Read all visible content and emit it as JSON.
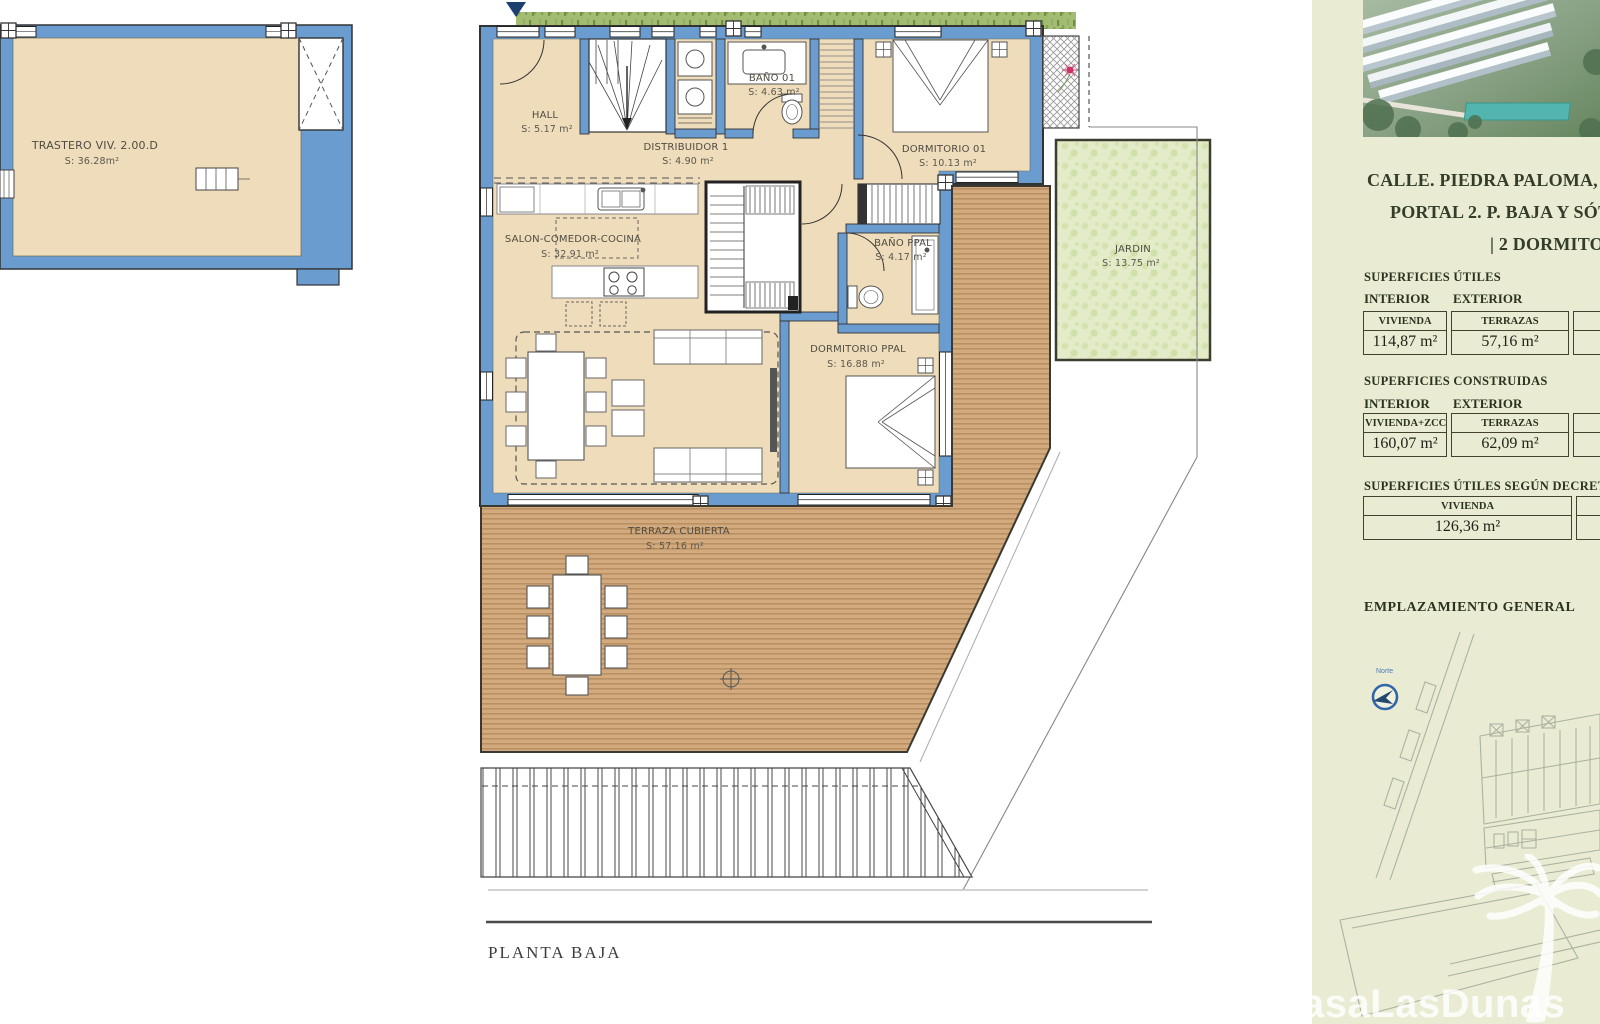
{
  "plan": {
    "title": "PLANTA BAJA",
    "rooms": [
      {
        "name": "TRASTERO VIV. 2.00.D",
        "area": "S: 36.28m²"
      },
      {
        "name": "HALL",
        "area": "S: 5.17 m²"
      },
      {
        "name": "BAÑO 01",
        "area": "S: 4.63 m²"
      },
      {
        "name": "DORMITORIO 01",
        "area": "S: 10.13 m²"
      },
      {
        "name": "DISTRIBUIDOR 1",
        "area": "S: 4.90 m²"
      },
      {
        "name": "SALON-COMEDOR-COCINA",
        "area": "S: 32.91 m²"
      },
      {
        "name": "BAÑO PPAL",
        "area": "S: 4.17 m²"
      },
      {
        "name": "DORMITORIO PPAL",
        "area": "S: 16.88 m²"
      },
      {
        "name": "JARDIN",
        "area": "S: 13.75 m²"
      },
      {
        "name": "TERRAZA CUBIERTA",
        "area": "S: 57.16 m²"
      }
    ]
  },
  "panel": {
    "address_lines": [
      "CALLE. PIEDRA PALOMA, 4. E",
      "PORTAL 2. P. BAJA Y SÓTA",
      "| 2 DORMITOR"
    ],
    "sections": [
      {
        "title": "SUPERFICIES ÚTILES",
        "col_labels": [
          "INTERIOR",
          "EXTERIOR"
        ],
        "cells": [
          {
            "header": "VIVIENDA",
            "value": "114,87 m²"
          },
          {
            "header": "TERRAZAS",
            "value": "57,16 m²"
          }
        ]
      },
      {
        "title": "SUPERFICIES CONSTRUIDAS",
        "col_labels": [
          "INTERIOR",
          "EXTERIOR"
        ],
        "cells": [
          {
            "header": "VIVIENDA+ZCC",
            "value": "160,07 m²"
          },
          {
            "header": "TERRAZAS",
            "value": "62,09 m²"
          }
        ]
      },
      {
        "title": "SUPERFICIES ÚTILES SEGÚN DECRETO E",
        "col_labels": [],
        "cells": [
          {
            "header": "VIVIENDA",
            "value": "126,36 m²"
          }
        ]
      }
    ],
    "emplazamiento_title": "EMPLAZAMIENTO GENERAL",
    "compass_label": "Norte",
    "watermark": "asaLasDunas"
  },
  "colors": {
    "wall_blue": "#6a9ccf",
    "room_tan": "#eedcbb",
    "deck_brown": "#d2aa7e",
    "garden_green": "#e3ebc9",
    "panel_bg": "#e9ecd3"
  }
}
